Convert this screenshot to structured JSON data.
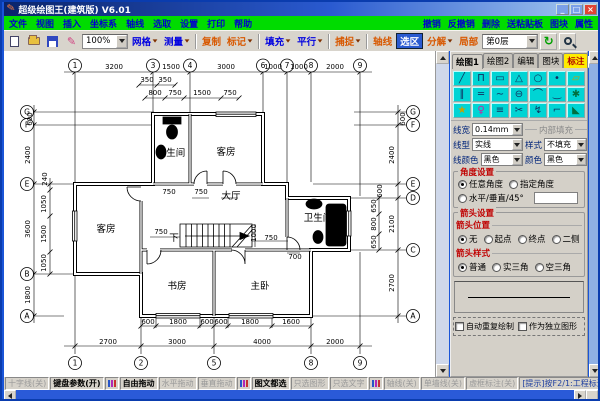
{
  "window": {
    "title": "超级绘图王(建筑版) V6.01",
    "minimize": "_",
    "maximize": "□",
    "close": "×"
  },
  "menubar": {
    "left": [
      "文件",
      "视图",
      "插入",
      "坐标系",
      "轴线",
      "选取",
      "设置",
      "打印",
      "帮助"
    ],
    "right": [
      "撤销",
      "反撤销",
      "删除",
      "送粘贴板",
      "图块",
      "属性"
    ]
  },
  "toolbar": {
    "zoom": "100%",
    "layer": "第0层",
    "buttons": [
      {
        "label": "网格",
        "color": "blue",
        "dd": true
      },
      {
        "label": "测量",
        "color": "blue",
        "dd": true
      },
      {
        "sep": true
      },
      {
        "label": "复制",
        "color": "orange",
        "dd": false
      },
      {
        "label": "标记",
        "color": "orange",
        "dd": true
      },
      {
        "sep": true
      },
      {
        "label": "填充",
        "color": "blue",
        "dd": true
      },
      {
        "label": "平行",
        "color": "blue",
        "dd": true
      },
      {
        "sep": true
      },
      {
        "label": "捕捉",
        "color": "orange",
        "dd": true
      },
      {
        "sep": true
      },
      {
        "label": "轴线",
        "color": "orange",
        "dd": false
      },
      {
        "label": "选区",
        "color": "sel",
        "dd": false
      },
      {
        "label": "分解",
        "color": "orange",
        "dd": true
      },
      {
        "label": "局部",
        "color": "orange",
        "dd": false
      }
    ]
  },
  "panel": {
    "tabs": [
      {
        "label": "绘图1",
        "state": "active"
      },
      {
        "label": "绘图2",
        "state": ""
      },
      {
        "label": "编辑",
        "state": ""
      },
      {
        "label": "图块",
        "state": ""
      },
      {
        "label": "标注",
        "state": "highlight"
      }
    ],
    "close_glyph": "×",
    "tools": [
      {
        "name": "line",
        "glyph": "╱",
        "cls": ""
      },
      {
        "name": "polyline",
        "glyph": "Π",
        "cls": ""
      },
      {
        "name": "rectangle",
        "glyph": "▭",
        "cls": ""
      },
      {
        "name": "polygon",
        "glyph": "△",
        "cls": ""
      },
      {
        "name": "circle",
        "glyph": "○",
        "cls": ""
      },
      {
        "name": "point",
        "glyph": "•",
        "cls": ""
      },
      {
        "name": "eraser",
        "glyph": "▱",
        "cls": "gold"
      },
      {
        "name": "parallel-lines",
        "glyph": "∥",
        "cls": ""
      },
      {
        "name": "construction-line",
        "glyph": "═",
        "cls": ""
      },
      {
        "name": "curve",
        "glyph": "∼",
        "cls": ""
      },
      {
        "name": "ellipse",
        "glyph": "⊖",
        "cls": ""
      },
      {
        "name": "arc",
        "glyph": "⌒",
        "cls": ""
      },
      {
        "name": "arc-segment",
        "glyph": "‿",
        "cls": ""
      },
      {
        "name": "pattern-brush",
        "glyph": "✱",
        "cls": "grn"
      },
      {
        "name": "star",
        "glyph": "★",
        "cls": "gold"
      },
      {
        "name": "figure",
        "glyph": "♀",
        "cls": "mag"
      },
      {
        "name": "stairs",
        "glyph": "≡",
        "cls": ""
      },
      {
        "name": "scissors",
        "glyph": "✂",
        "cls": ""
      },
      {
        "name": "break-line",
        "glyph": "↯",
        "cls": ""
      },
      {
        "name": "fillet",
        "glyph": "⌐",
        "cls": ""
      },
      {
        "name": "fill-bucket",
        "glyph": "◣",
        "cls": "grn"
      }
    ],
    "line_width_label": "线宽",
    "line_width_value": "0.14mm",
    "line_type_label": "线型",
    "line_type_value": "实线",
    "line_color_label": "线颜色",
    "line_color_value": "黑色",
    "fill": {
      "group": "内部填充",
      "style_label": "样式",
      "style_value": "不填充",
      "color_label": "颜色",
      "color_value": "黑色"
    },
    "angle": {
      "title": "角度设置",
      "any": "任意角度",
      "fixed": "指定角度",
      "hv": "水平/垂直/45°",
      "input_value": ""
    },
    "arrow": {
      "title": "箭头设置",
      "pos_label": "箭头位置",
      "pos_options": [
        "无",
        "起点",
        "终点",
        "二侧"
      ],
      "pos_selected": 0,
      "style_label": "箭头样式",
      "style_options": [
        "普通",
        "实三角",
        "空三角"
      ],
      "style_selected": 0
    },
    "footer_checks": [
      "自动重复绘制",
      "作为独立图形"
    ]
  },
  "statusbar": [
    {
      "label": "十字线(关)",
      "active": false
    },
    {
      "label": "键盘参数(开)",
      "active": true
    },
    {
      "sep": true
    },
    {
      "label": "自由拖动",
      "active": true
    },
    {
      "label": "水平拖动",
      "active": false
    },
    {
      "label": "垂直拖动",
      "active": false
    },
    {
      "sep": true
    },
    {
      "label": "图文都选",
      "active": true
    },
    {
      "label": "只选图形",
      "active": false
    },
    {
      "label": "只选文字",
      "active": false
    },
    {
      "sep": true
    },
    {
      "label": "轴线(关)",
      "active": false
    },
    {
      "label": "单墙线(关)",
      "active": false
    },
    {
      "label": "虚框标注(关)",
      "active": false
    },
    {
      "label": "[提示]按F2/1:工程标注",
      "active": false,
      "hint": true
    }
  ],
  "plan": {
    "texts": [
      {
        "t": "1",
        "x": 71,
        "y": 14.5,
        "b": 1
      },
      {
        "t": "3",
        "x": 149,
        "y": 14.5,
        "b": 1
      },
      {
        "t": "4",
        "x": 186,
        "y": 14.5,
        "b": 1
      },
      {
        "t": "6",
        "x": 259,
        "y": 14.5,
        "b": 1
      },
      {
        "t": "7",
        "x": 283,
        "y": 14.5,
        "b": 1
      },
      {
        "t": "8",
        "x": 307,
        "y": 14.5,
        "b": 1
      },
      {
        "t": "9",
        "x": 356,
        "y": 14.5,
        "b": 1
      },
      {
        "t": "3200",
        "x": 110,
        "y": 18
      },
      {
        "t": "1500",
        "x": 167,
        "y": 18
      },
      {
        "t": "3000",
        "x": 222,
        "y": 18
      },
      {
        "t": "1000",
        "x": 269,
        "y": 18
      },
      {
        "t": "1000",
        "x": 295,
        "y": 18
      },
      {
        "t": "2000",
        "x": 331,
        "y": 18
      },
      {
        "t": "350",
        "x": 143,
        "y": 31
      },
      {
        "t": "350",
        "x": 161,
        "y": 31
      },
      {
        "t": "800",
        "x": 151,
        "y": 44
      },
      {
        "t": "750",
        "x": 171,
        "y": 44
      },
      {
        "t": "1500",
        "x": 198,
        "y": 44
      },
      {
        "t": "750",
        "x": 226,
        "y": 44
      },
      {
        "t": "G",
        "x": 23,
        "y": 61,
        "b": 1
      },
      {
        "t": "F",
        "x": 23,
        "y": 74,
        "b": 1
      },
      {
        "t": "E",
        "x": 23,
        "y": 133,
        "b": 1
      },
      {
        "t": "B",
        "x": 23,
        "y": 223,
        "b": 1
      },
      {
        "t": "A",
        "x": 23,
        "y": 265,
        "b": 1
      },
      {
        "t": "600",
        "x": 28,
        "y": 68,
        "r": -90
      },
      {
        "t": "2400",
        "x": 26,
        "y": 104,
        "r": -90
      },
      {
        "t": "3600",
        "x": 26,
        "y": 178,
        "r": -90
      },
      {
        "t": "1800",
        "x": 26,
        "y": 244,
        "r": -90
      },
      {
        "t": "240",
        "x": 43,
        "y": 128,
        "r": -90
      },
      {
        "t": "1050",
        "x": 42,
        "y": 153,
        "r": -90
      },
      {
        "t": "1500",
        "x": 42,
        "y": 183,
        "r": -90
      },
      {
        "t": "1050",
        "x": 42,
        "y": 212,
        "r": -90
      },
      {
        "t": "G",
        "x": 409,
        "y": 61,
        "b": 1
      },
      {
        "t": "F",
        "x": 409,
        "y": 74,
        "b": 1
      },
      {
        "t": "E",
        "x": 409,
        "y": 133,
        "b": 1
      },
      {
        "t": "D",
        "x": 409,
        "y": 147,
        "b": 1
      },
      {
        "t": "C",
        "x": 409,
        "y": 199,
        "b": 1
      },
      {
        "t": "A",
        "x": 409,
        "y": 265,
        "b": 1
      },
      {
        "t": "600",
        "x": 401,
        "y": 68,
        "r": -90
      },
      {
        "t": "2400",
        "x": 390,
        "y": 104,
        "r": -90
      },
      {
        "t": "600",
        "x": 378,
        "y": 140,
        "r": -90
      },
      {
        "t": "2100",
        "x": 390,
        "y": 173,
        "r": -90
      },
      {
        "t": "2700",
        "x": 390,
        "y": 232,
        "r": -90
      },
      {
        "t": "650",
        "x": 372,
        "y": 155,
        "r": -90
      },
      {
        "t": "800",
        "x": 372,
        "y": 173,
        "r": -90
      },
      {
        "t": "650",
        "x": 372,
        "y": 191,
        "r": -90
      },
      {
        "t": "600",
        "x": 144,
        "y": 273
      },
      {
        "t": "1800",
        "x": 174,
        "y": 273
      },
      {
        "t": "600",
        "x": 203,
        "y": 273
      },
      {
        "t": "600",
        "x": 217,
        "y": 273
      },
      {
        "t": "1800",
        "x": 246,
        "y": 273
      },
      {
        "t": "1600",
        "x": 287,
        "y": 273
      },
      {
        "t": "2700",
        "x": 104,
        "y": 293
      },
      {
        "t": "3000",
        "x": 173,
        "y": 293
      },
      {
        "t": "4000",
        "x": 258,
        "y": 293
      },
      {
        "t": "2000",
        "x": 331,
        "y": 293
      },
      {
        "t": "1",
        "x": 71,
        "y": 312,
        "b": 1
      },
      {
        "t": "2",
        "x": 137,
        "y": 312,
        "b": 1
      },
      {
        "t": "5",
        "x": 210,
        "y": 312,
        "b": 1
      },
      {
        "t": "8",
        "x": 307,
        "y": 312,
        "b": 1
      },
      {
        "t": "9",
        "x": 356,
        "y": 312,
        "b": 1
      },
      {
        "t": "卫生间",
        "x": 167,
        "y": 105,
        "cls": "room"
      },
      {
        "t": "客房",
        "x": 222,
        "y": 104,
        "cls": "room"
      },
      {
        "t": "客房",
        "x": 102,
        "y": 181,
        "cls": "room"
      },
      {
        "t": "大厅",
        "x": 227,
        "y": 148,
        "cls": "room"
      },
      {
        "t": "卫生间",
        "x": 314,
        "y": 170,
        "cls": "room"
      },
      {
        "t": "书房",
        "x": 173,
        "y": 238,
        "cls": "room"
      },
      {
        "t": "主卧",
        "x": 256,
        "y": 238,
        "cls": "room"
      },
      {
        "t": "750",
        "x": 165,
        "y": 143
      },
      {
        "t": "750",
        "x": 197,
        "y": 143
      },
      {
        "t": "750",
        "x": 157,
        "y": 183
      },
      {
        "t": "下",
        "x": 170,
        "y": 190,
        "cls": "room"
      },
      {
        "t": "1000",
        "x": 252,
        "y": 182,
        "r": -90
      },
      {
        "t": "750",
        "x": 267,
        "y": 189
      },
      {
        "t": "700",
        "x": 291,
        "y": 208
      }
    ]
  }
}
